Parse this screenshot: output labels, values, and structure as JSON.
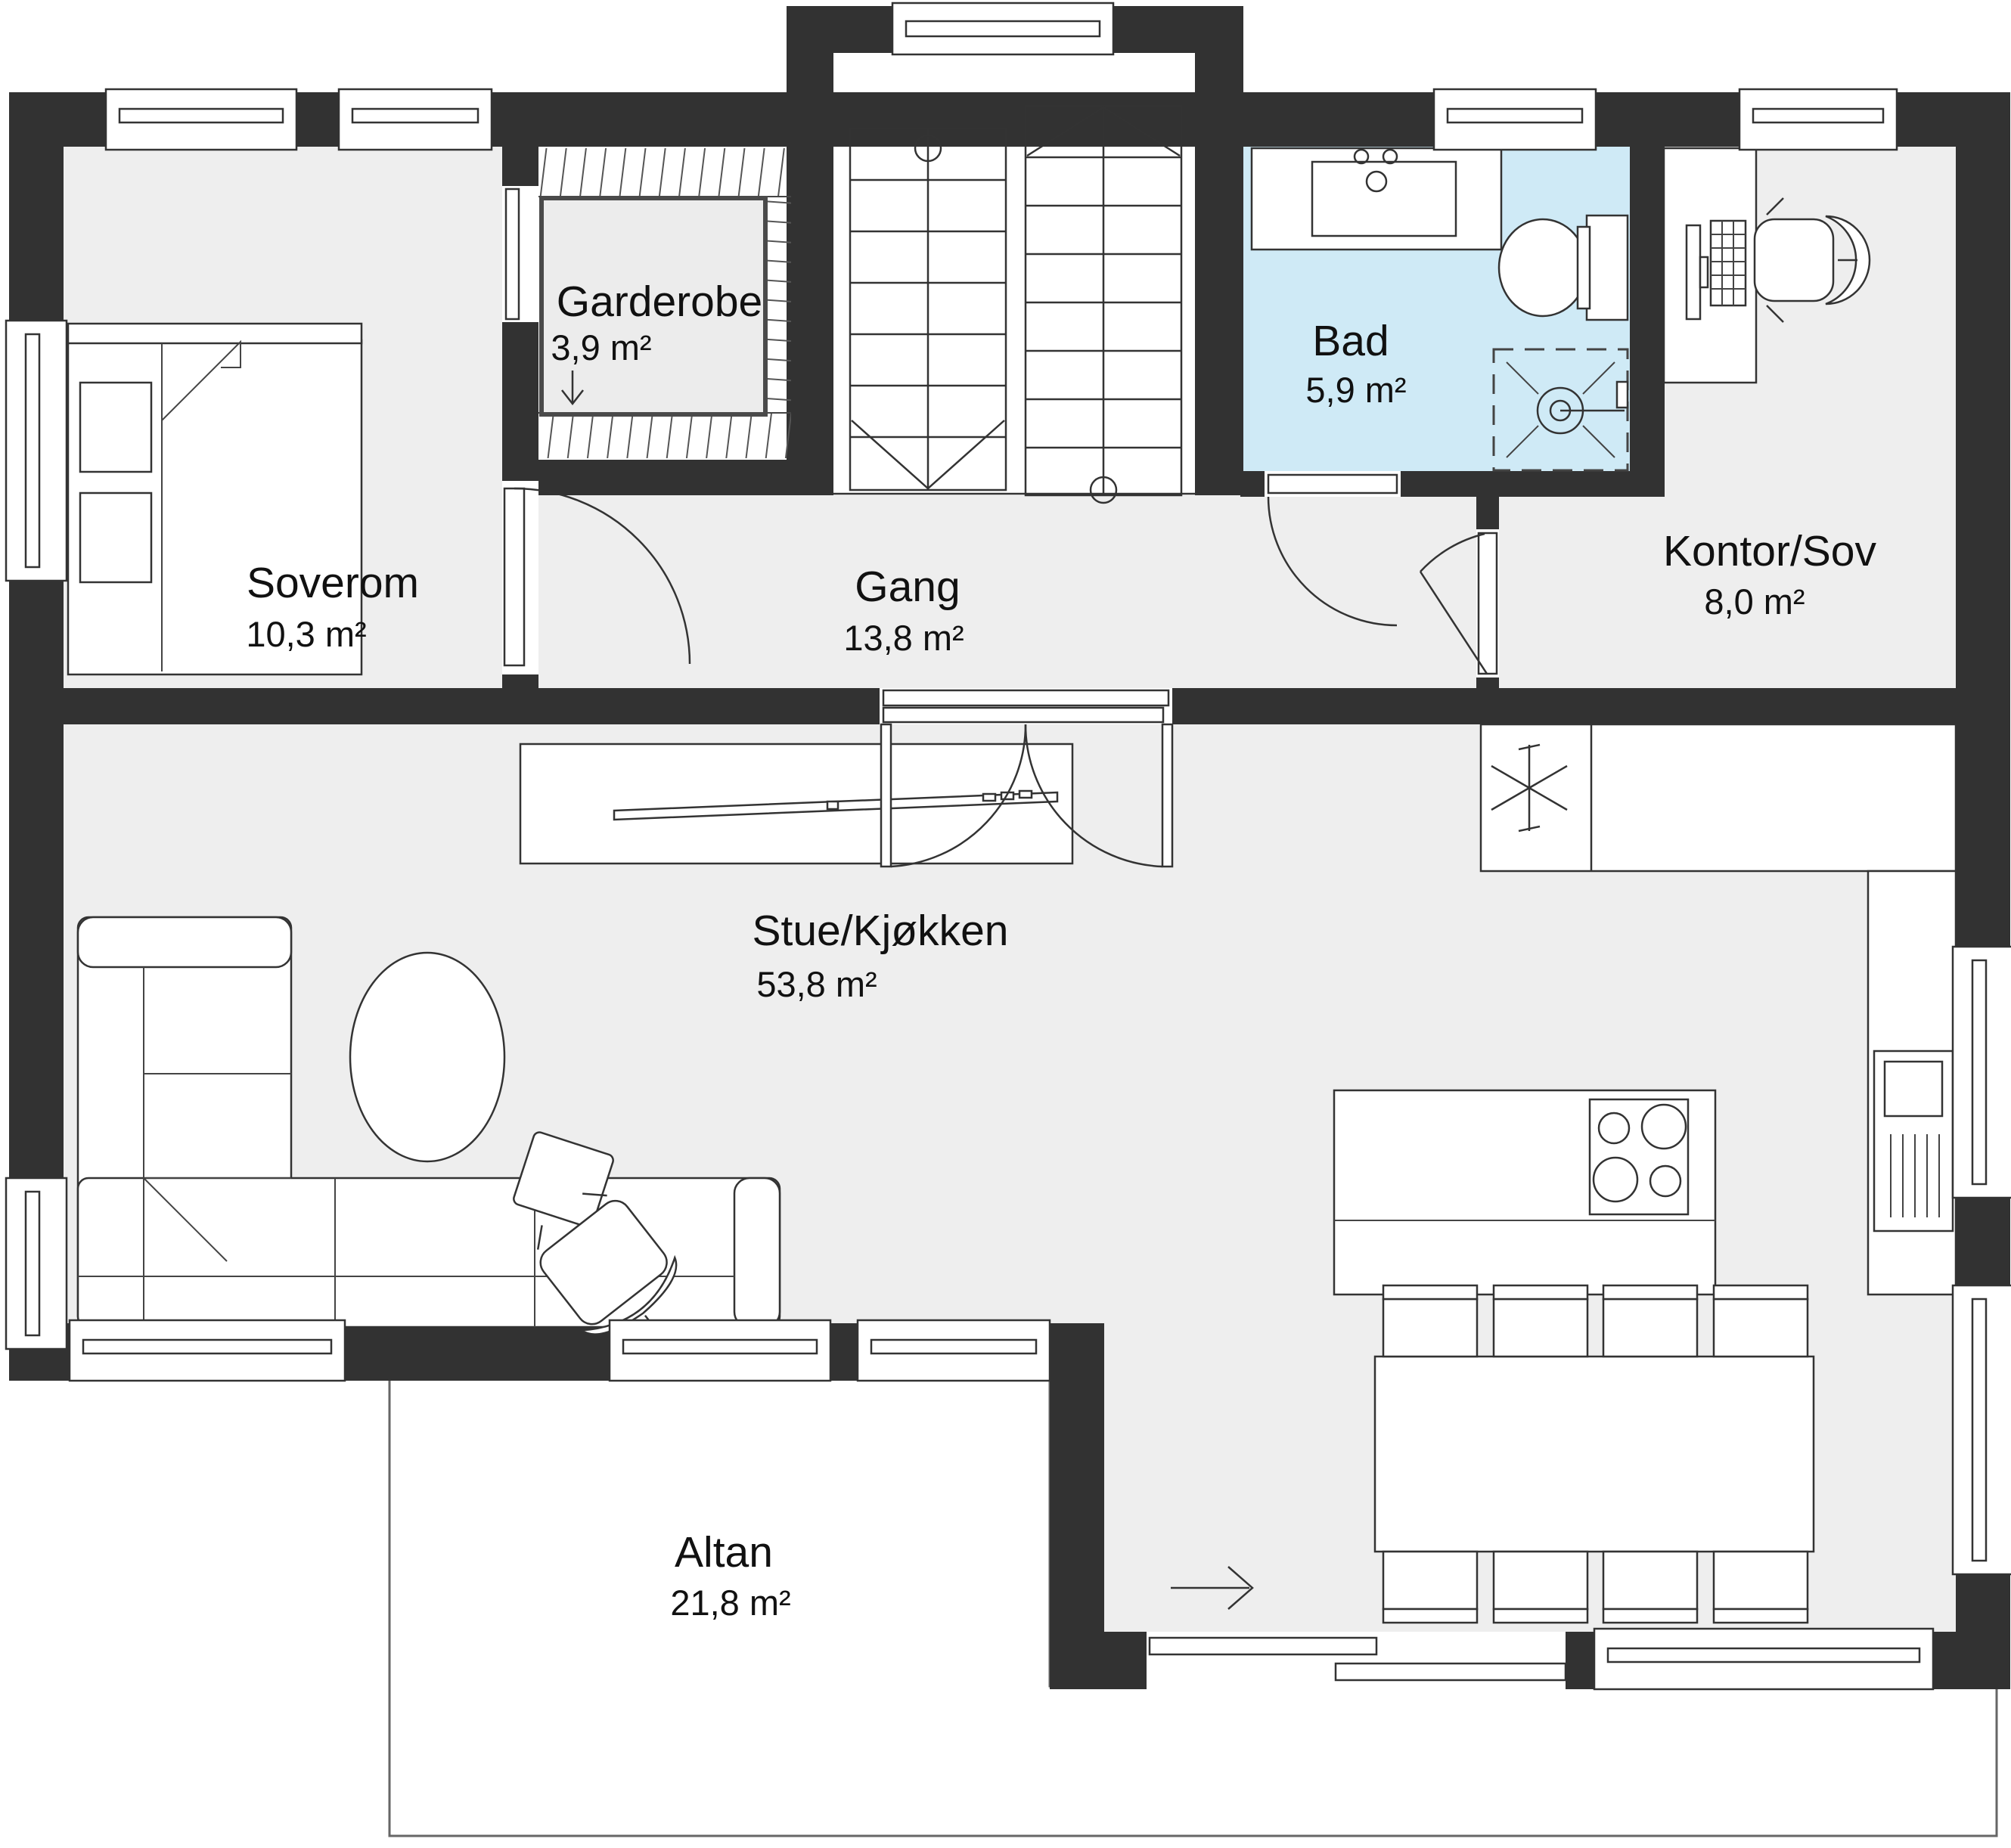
{
  "plan": {
    "type": "floor-plan",
    "rooms": [
      {
        "id": "soverom",
        "name": "Soverom",
        "area": "10,3 m²"
      },
      {
        "id": "garderobe",
        "name": "Garderobe",
        "area": "3,9 m²"
      },
      {
        "id": "gang",
        "name": "Gang",
        "area": "13,8 m²"
      },
      {
        "id": "bad",
        "name": "Bad",
        "area": "5,9 m²"
      },
      {
        "id": "kontor-sov",
        "name": "Kontor/Sov",
        "area": "8,0 m²"
      },
      {
        "id": "stue-kjokken",
        "name": "Stue/Kjøkken",
        "area": "53,8 m²"
      },
      {
        "id": "altan",
        "name": "Altan",
        "area": "21,8 m²"
      }
    ],
    "colors": {
      "wall": "#323232",
      "floor": "#eeeeee",
      "bathroom_floor": "#cfeaf6",
      "deck_border": "#666666",
      "outline": "#333333",
      "text": "#111111"
    },
    "icons": {
      "garderobe-direction-arrow": "↓",
      "sliding-door-direction-arrow": "→",
      "stair-up-chevron": "∧",
      "stair-down-chevron": "∨",
      "fridge-freezer-star": "✳"
    }
  }
}
